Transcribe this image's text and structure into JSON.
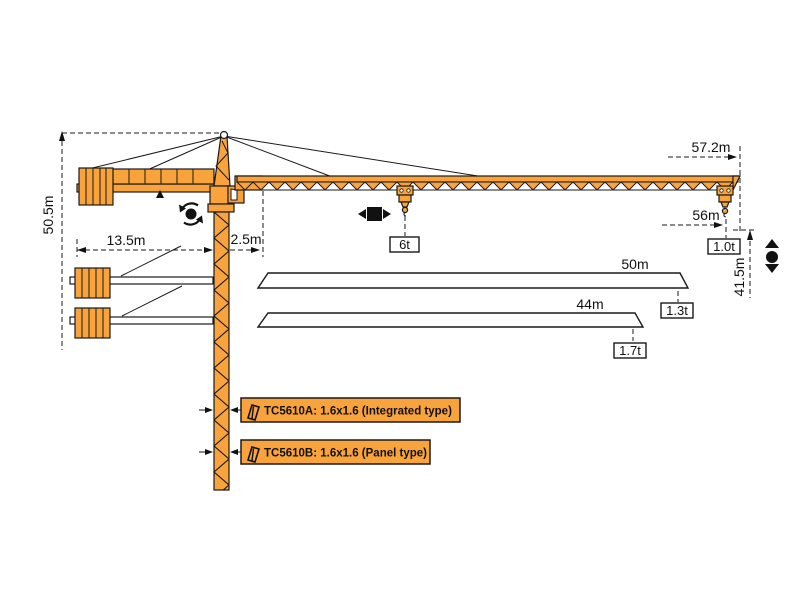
{
  "diagram": {
    "title": "TC5610 tower crane working range and dimension diagram",
    "colors": {
      "crane_orange": "#F8A33B",
      "outline_black": "#1A1A1A",
      "background": "#FFFFFF"
    },
    "dimensions": {
      "total_height": "50.5m",
      "counter_jib_radius": "13.5m",
      "jib_root_offset": "2.5m",
      "overall_jib_reach": "57.2m",
      "tip_working_radius": "56m",
      "hook_height": "41.5m"
    },
    "capacities": {
      "max_load": "6t",
      "tip_load_56m": "1.0t",
      "tip_load_50m": "1.3t",
      "tip_load_44m": "1.7t"
    },
    "jib_options": {
      "jib_50": "50m",
      "jib_44": "44m"
    },
    "mast_models": [
      {
        "label": "TC5610A: 1.6x1.6 (Integrated type)"
      },
      {
        "label": "TC5610B: 1.6x1.6 (Panel type)"
      }
    ],
    "icons": {
      "slewing": "slewing-rotation-icon",
      "trolley": "trolley-travel-icon",
      "hoist": "hook-hoisting-icon"
    }
  }
}
